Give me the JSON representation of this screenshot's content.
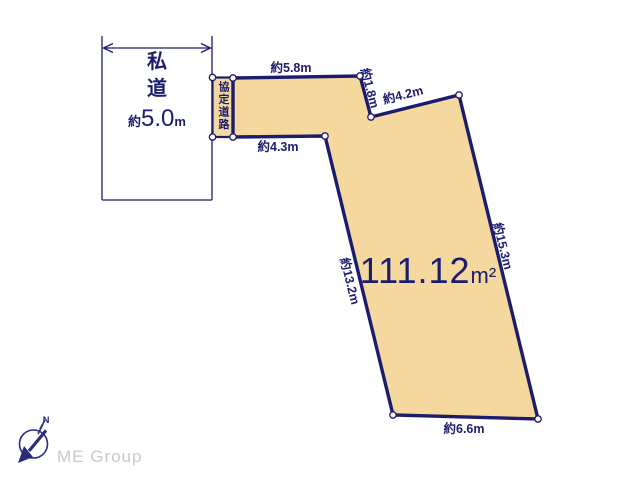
{
  "colors": {
    "plot_fill": "#F5D89E",
    "line": "#1C1C6E",
    "text": "#1C1C6E",
    "logo": "#2A2A7E",
    "logo_text": "#C9C9CD",
    "background": "#FFFFFF"
  },
  "road_box": {
    "name_char1": "私",
    "name_char2": "道",
    "width_prefix": "約",
    "width_value": "5.0",
    "width_unit": "m"
  },
  "agreement_road": {
    "label": "協定道路"
  },
  "area": {
    "value": "111.12",
    "unit": "m²"
  },
  "edges": {
    "top": "約5.8m",
    "notch_right": "約1.8m",
    "upper_right": "約4.2m",
    "right": "約15.3m",
    "bottom": "約6.6m",
    "left": "約13.2m",
    "upper_left": "約4.3m"
  },
  "logo": {
    "text": "ME Group",
    "compass_n": "N"
  }
}
